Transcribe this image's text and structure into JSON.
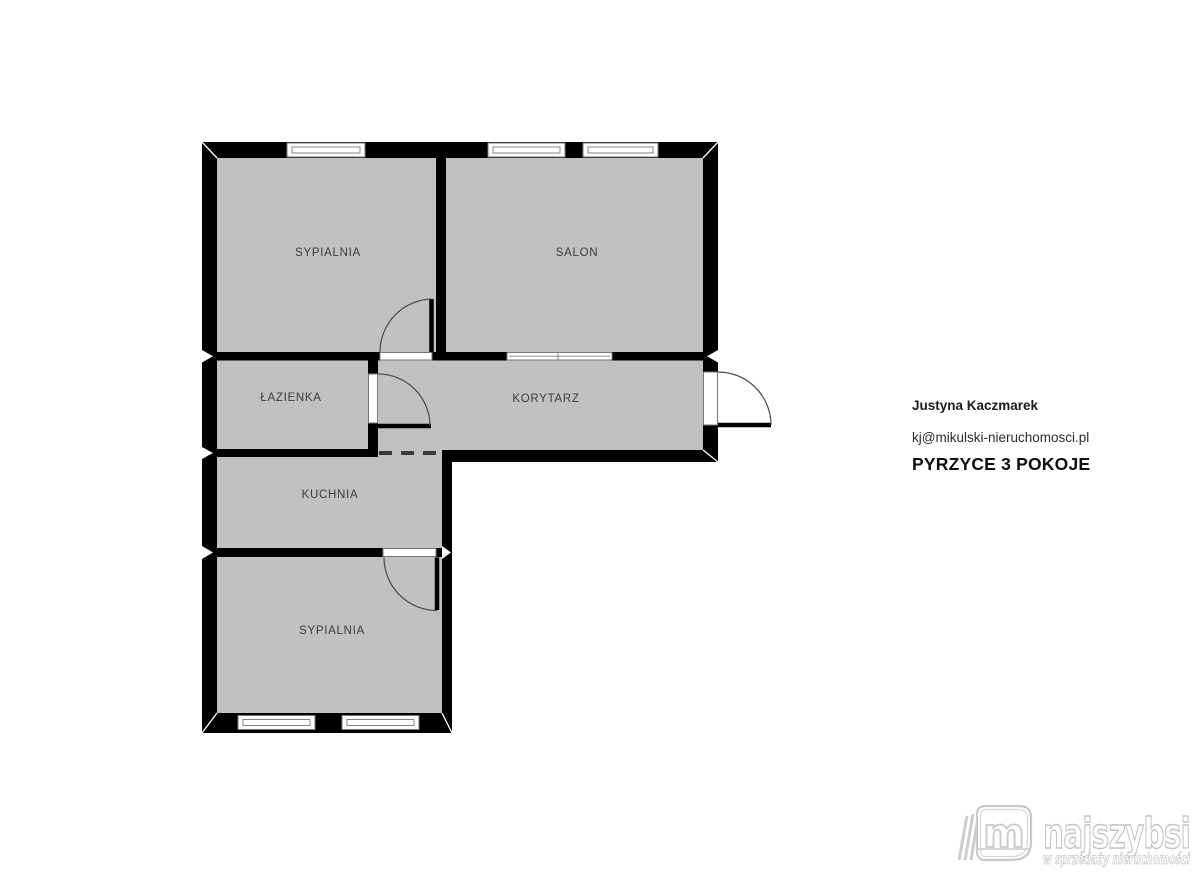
{
  "floorplan": {
    "rooms": [
      {
        "label": "SYPIALNIA"
      },
      {
        "label": "SALON"
      },
      {
        "label": "ŁAZIENKA"
      },
      {
        "label": "KORYTARZ"
      },
      {
        "label": "KUCHNIA"
      },
      {
        "label": "SYPIALNIA"
      }
    ],
    "colors": {
      "wall": "#000000",
      "floor_fill": "#c1c1bf",
      "label_text": "#3c3c3c",
      "background": "#ffffff"
    }
  },
  "agent": {
    "name": "Justyna Kaczmarek",
    "email": "kj@mikulski-nieruchomosci.pl",
    "listing_title": "PYRZYCE 3 POKOJE"
  },
  "logo": {
    "brand": "najszybsi",
    "tagline": "w sprzedaży nieruchomości",
    "monogram": "m",
    "color": "#c9c9c9"
  }
}
